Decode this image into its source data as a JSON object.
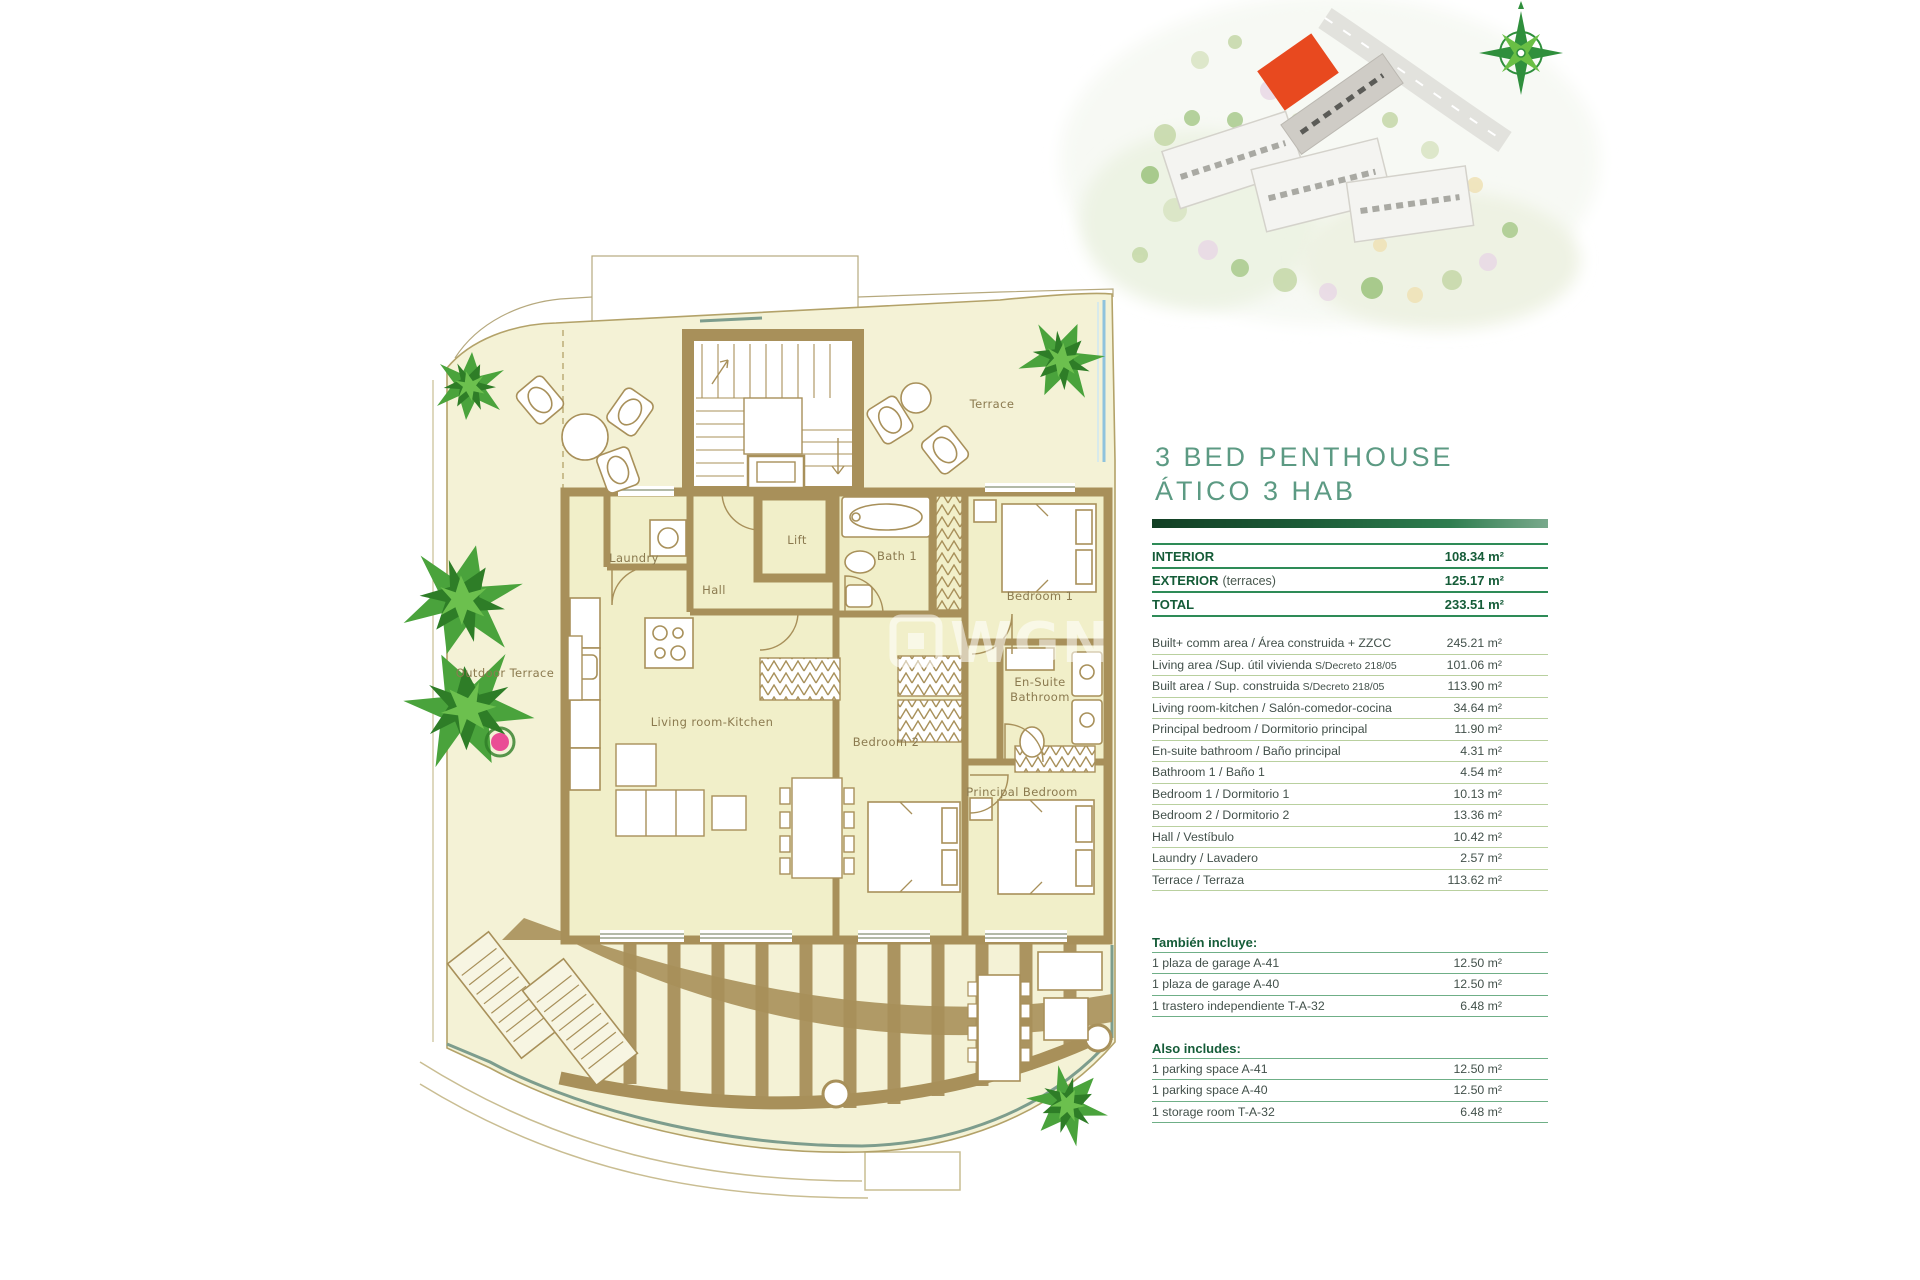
{
  "title": {
    "line1": "3 BED PENTHOUSE",
    "line2": "ÁTICO 3 HAB"
  },
  "summary": {
    "rows": [
      {
        "label": "INTERIOR",
        "note": "",
        "value": "108.34 m²"
      },
      {
        "label": "EXTERIOR",
        "note": "(terraces)",
        "value": "125.17 m²"
      },
      {
        "label": "TOTAL",
        "note": "",
        "value": "233.51 m²"
      }
    ]
  },
  "details": {
    "rows": [
      {
        "label": "Built+ comm  area / Área construida + ZZCC",
        "label_small": "",
        "value": "245.21 m²"
      },
      {
        "label": "Living area /Sup. útil vivienda",
        "label_small": "S/Decreto 218/05",
        "value": "101.06 m²"
      },
      {
        "label": "Built area / Sup. construida",
        "label_small": "S/Decreto 218/05",
        "value": "113.90 m²"
      },
      {
        "label": "Living room-kitchen / Salón-comedor-cocina",
        "label_small": "",
        "value": "34.64 m²"
      },
      {
        "label": "Principal bedroom / Dormitorio principal",
        "label_small": "",
        "value": "11.90 m²"
      },
      {
        "label": "En-suite bathroom / Baño principal",
        "label_small": "",
        "value": "4.31 m²"
      },
      {
        "label": "Bathroom 1 / Baño 1",
        "label_small": "",
        "value": "4.54 m²"
      },
      {
        "label": "Bedroom 1 / Dormitorio 1",
        "label_small": "",
        "value": "10.13 m²"
      },
      {
        "label": "Bedroom 2 / Dormitorio 2",
        "label_small": "",
        "value": "13.36 m²"
      },
      {
        "label": "Hall / Vestíbulo",
        "label_small": "",
        "value": "10.42 m²"
      },
      {
        "label": "Laundry / Lavadero",
        "label_small": "",
        "value": "2.57 m²"
      },
      {
        "label": "Terrace / Terraza",
        "label_small": "",
        "value": "113.62 m²"
      }
    ]
  },
  "includes_es": {
    "heading": "También incluye:",
    "rows": [
      {
        "label": "1 plaza de garage A-41",
        "value": "12.50 m²"
      },
      {
        "label": "1 plaza de garage A-40",
        "value": "12.50 m²"
      },
      {
        "label": "1 trastero independiente T-A-32",
        "value": "6.48 m²"
      }
    ]
  },
  "includes_en": {
    "heading": "Also includes:",
    "rows": [
      {
        "label": "1 parking space A-41",
        "value": "12.50 m²"
      },
      {
        "label": "1 parking space A-40",
        "value": "12.50 m²"
      },
      {
        "label": "1 storage room T-A-32",
        "value": "6.48 m²"
      }
    ]
  },
  "plan": {
    "labels": {
      "terrace": "Terrace",
      "outdoor_terrace": "Outdoor Terrace",
      "laundry": "Laundry",
      "hall": "Hall",
      "lift": "Lift",
      "bath1": "Bath 1",
      "bedroom1": "Bedroom 1",
      "ensuite_line1": "En-Suite",
      "ensuite_line2": "Bathroom",
      "living": "Living room-Kitchen",
      "bedroom2": "Bedroom 2",
      "principal": "Principal Bedroom"
    }
  },
  "watermark": {
    "text": "WGN"
  },
  "colors": {
    "wall_brown": "#a8905a",
    "interior_fill": "#f1efc9",
    "terrace_fill": "#f4f2d6",
    "accent_green_dark": "#155c38",
    "rule_green": "#2e8b57",
    "rule_light": "#b9d09f",
    "title_green": "#5c9a83",
    "highlight_orange": "#e8491f",
    "glass_blue": "#8fc3dd",
    "rail_green": "#7d9d8d"
  }
}
